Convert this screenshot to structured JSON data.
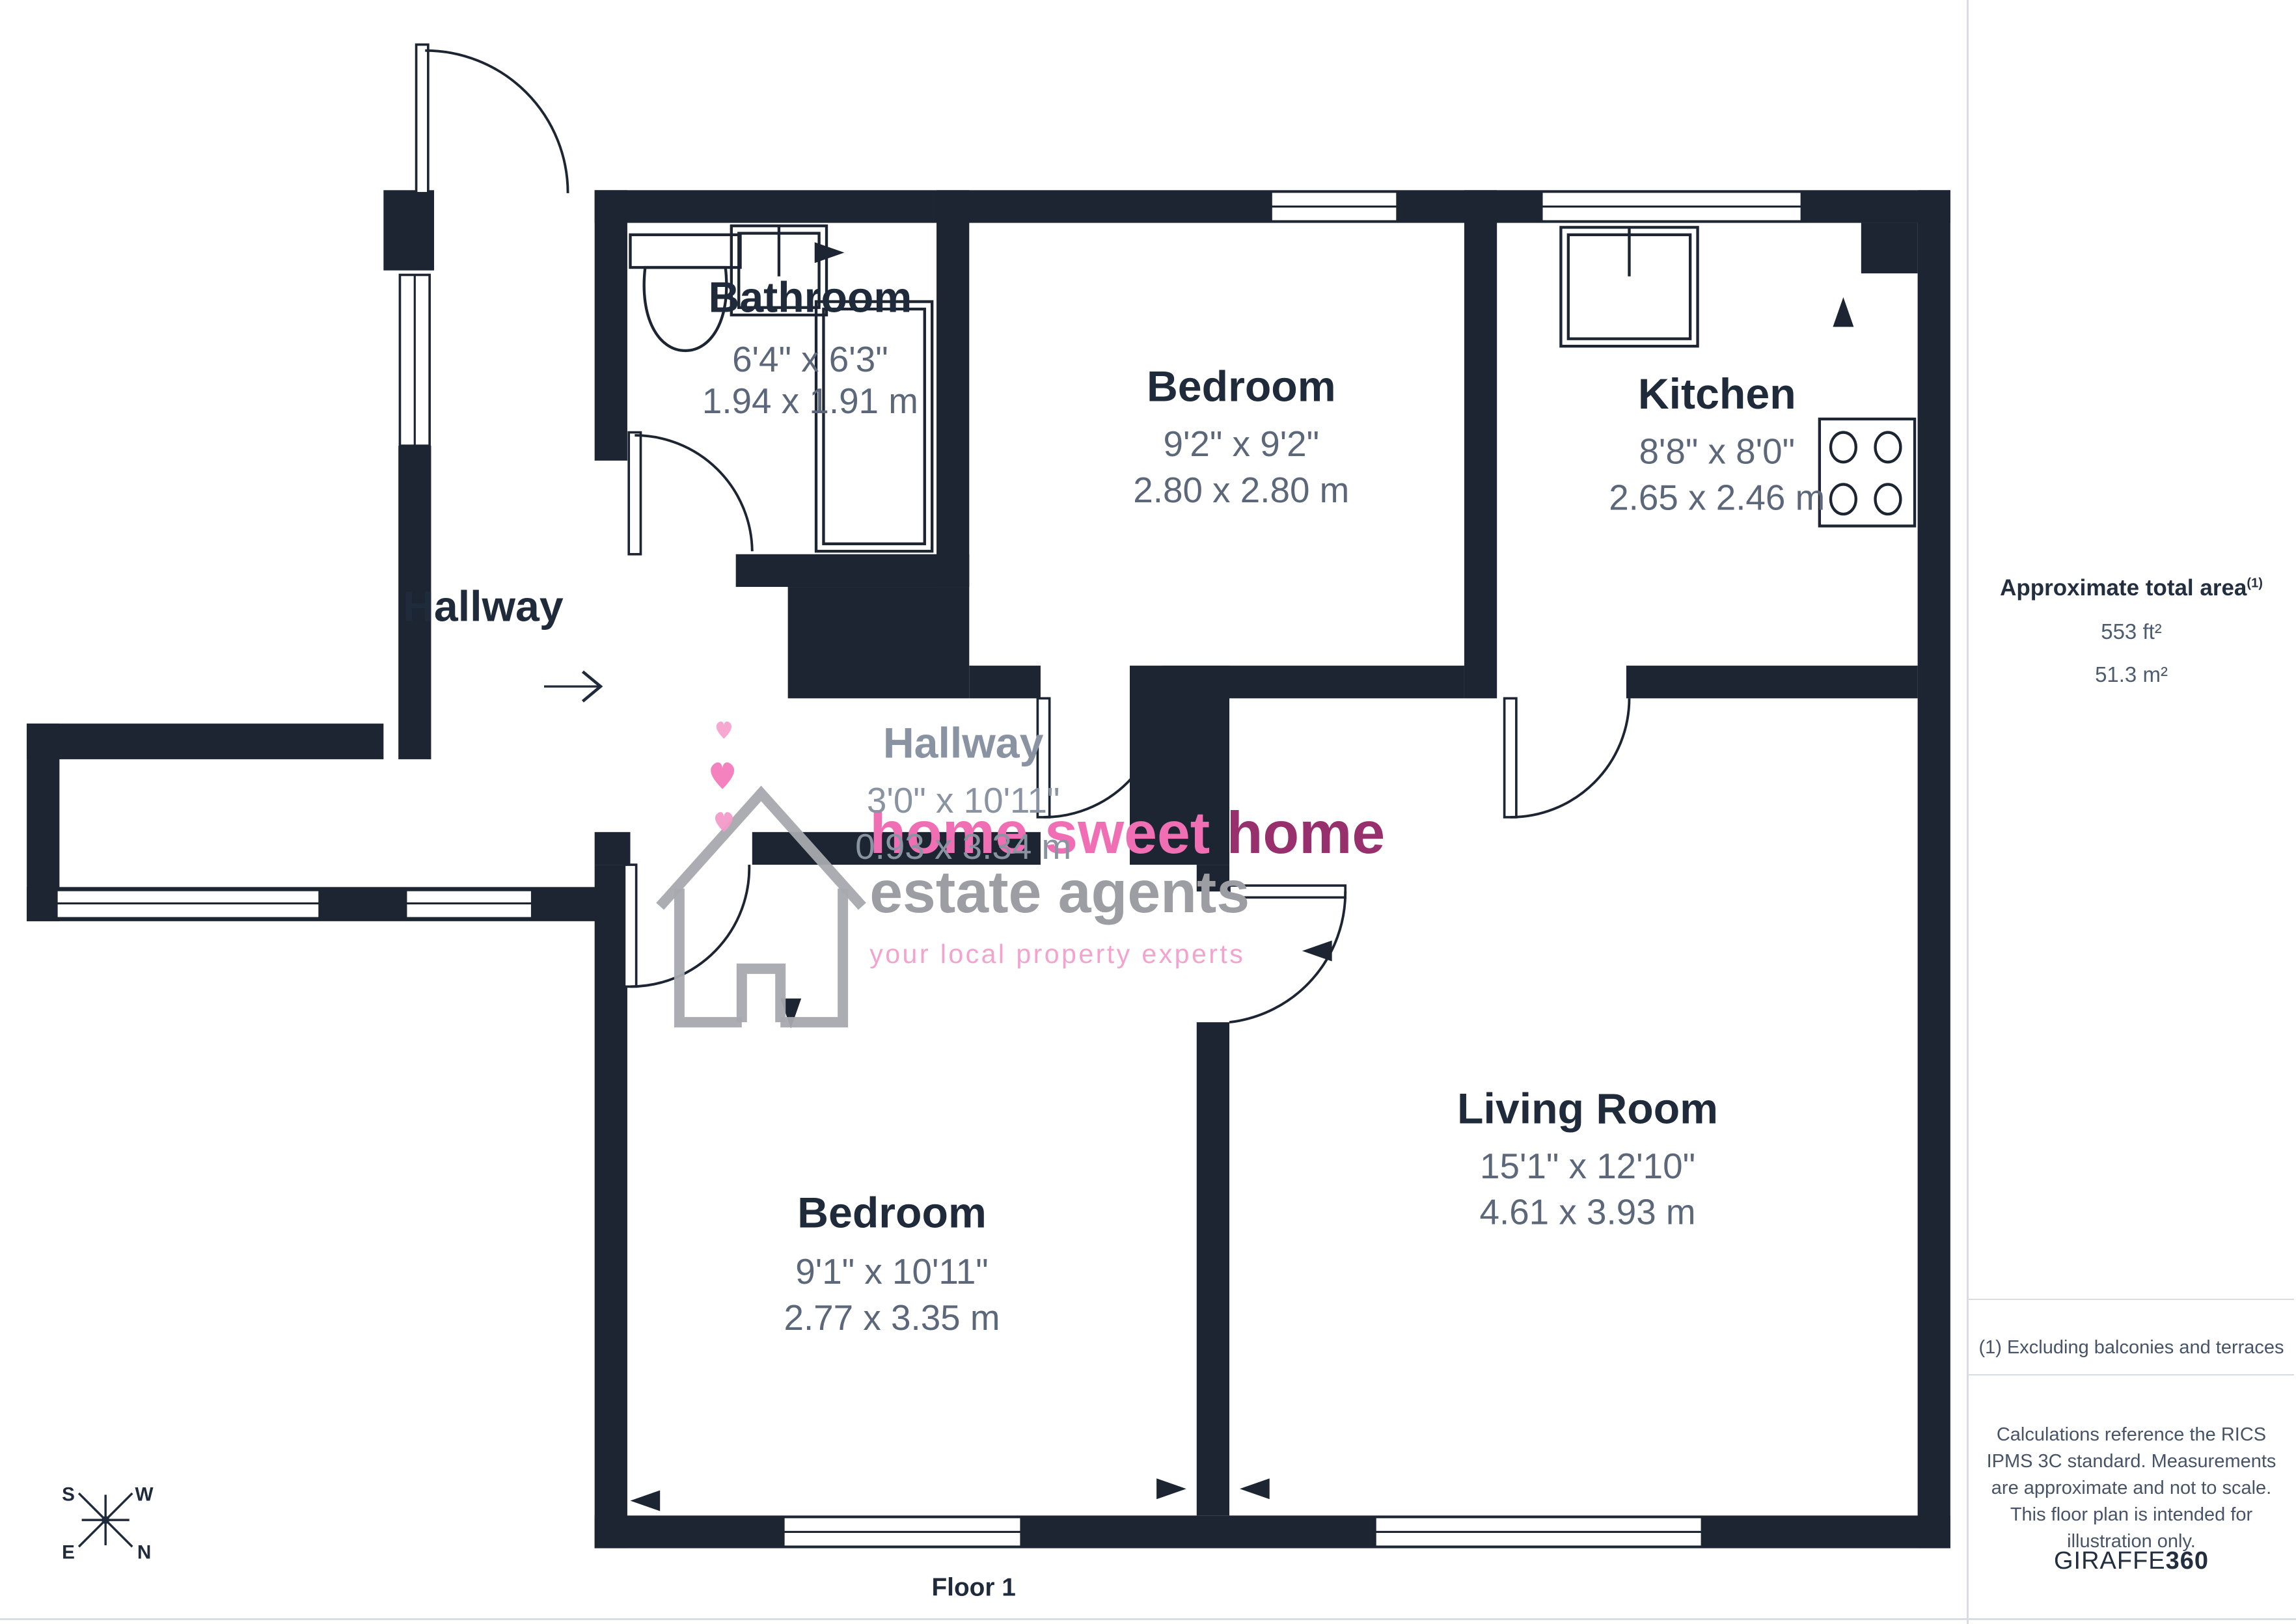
{
  "page": {
    "floor_label": "Floor 1"
  },
  "rooms": {
    "bathroom": {
      "name": "Bathroom",
      "imperial": "6'4\" x 6'3\"",
      "metric": "1.94 x 1.91 m"
    },
    "bedroom_top": {
      "name": "Bedroom",
      "imperial": "9'2\" x 9'2\"",
      "metric": "2.80 x 2.80 m"
    },
    "kitchen": {
      "name": "Kitchen",
      "imperial": "8'8\" x 8'0\"",
      "metric": "2.65 x 2.46 m"
    },
    "hallway_entrance": {
      "name": "Hallway"
    },
    "hallway_inner": {
      "name": "Hallway",
      "imperial": "3'0\" x 10'11\"",
      "metric": "0.93 x 3.34 m"
    },
    "bedroom_bottom": {
      "name": "Bedroom",
      "imperial": "9'1\" x 10'11\"",
      "metric": "2.77 x 3.35 m"
    },
    "living_room": {
      "name": "Living Room",
      "imperial": "15'1\" x 12'10\"",
      "metric": "4.61 x 3.93 m"
    }
  },
  "compass": {
    "n": "N",
    "s": "S",
    "e": "E",
    "w": "W"
  },
  "watermark": {
    "brand_head": "home sweet ",
    "brand_tail": "home",
    "line2": "estate agents",
    "tagline": "your local property experts"
  },
  "sidebar": {
    "area_title": "Approximate total area",
    "area_note_ref": "(1)",
    "area_ft": "553 ft²",
    "area_m": "51.3 m²",
    "note": "(1) Excluding balconies and terraces",
    "disclaimer": "Calculations reference the RICS IPMS 3C standard. Measurements are approximate and not to scale. This floor plan is intended for illustration only.",
    "brand_name": "GIRAFFE",
    "brand_suffix": "360"
  },
  "colors": {
    "wall": "#1C2531",
    "dim_text": "#5C6879",
    "accent_pink": "#F06FB4"
  }
}
